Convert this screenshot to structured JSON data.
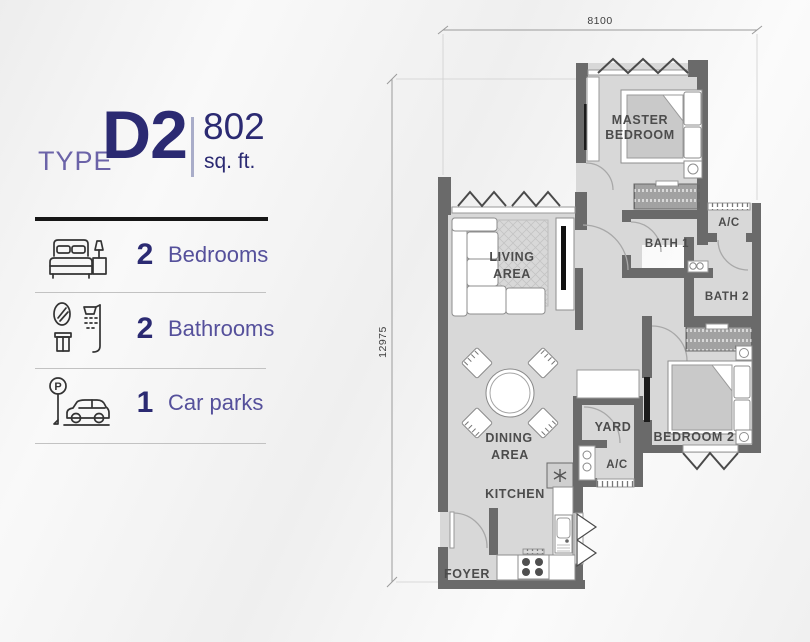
{
  "unit": {
    "type_label": "TYPE",
    "type_value": "D2",
    "area_value": "802",
    "area_unit": "sq. ft."
  },
  "amenities": [
    {
      "icon": "bed-icon",
      "count": "2",
      "label": "Bedrooms"
    },
    {
      "icon": "shower-icon",
      "count": "2",
      "label": "Bathrooms"
    },
    {
      "icon": "parking-icon",
      "count": "1",
      "label": "Car parks",
      "sign_glyph": "P"
    }
  ],
  "floor_plan": {
    "dim_top": "8100",
    "dim_left": "12975",
    "rooms": [
      {
        "name": "master-bedroom",
        "lines": [
          "MASTER",
          "BEDROOM"
        ]
      },
      {
        "name": "living-area",
        "lines": [
          "LIVING",
          "AREA"
        ]
      },
      {
        "name": "bath-1",
        "lines": [
          "BATH 1"
        ]
      },
      {
        "name": "ac-upper",
        "lines": [
          "A/C"
        ]
      },
      {
        "name": "bath-2",
        "lines": [
          "BATH 2"
        ]
      },
      {
        "name": "bedroom-2",
        "lines": [
          "BEDROOM 2"
        ]
      },
      {
        "name": "yard",
        "lines": [
          "YARD"
        ]
      },
      {
        "name": "ac-lower",
        "lines": [
          "A/C"
        ]
      },
      {
        "name": "dining-area",
        "lines": [
          "DINING",
          "AREA"
        ]
      },
      {
        "name": "kitchen",
        "lines": [
          "KITCHEN"
        ]
      },
      {
        "name": "foyer",
        "lines": [
          "FOYER"
        ]
      }
    ]
  },
  "colors": {
    "accent_navy": "#2b2a72",
    "accent_purple": "#55509b",
    "wall_gray": "#6a6a6a",
    "floor_gray": "#d8d8d8"
  }
}
